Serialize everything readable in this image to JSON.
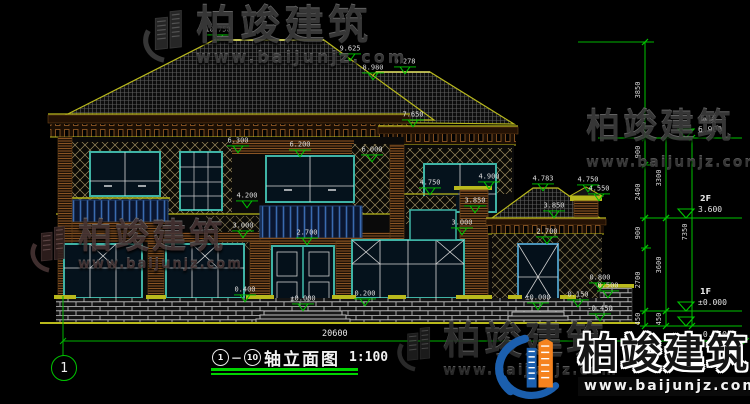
{
  "colors": {
    "annotation_green": "#00c400",
    "line_yellow": "#b9b91c",
    "window_teal": "#3fb3a5",
    "brand_blue": "#1b5fae",
    "brand_orange": "#f5831f"
  },
  "watermarks": {
    "brand": "柏竣建筑",
    "url": "www.baijunjz.com"
  },
  "logo": {
    "brand": "柏竣建筑",
    "url": "www.baijunjz.com"
  },
  "title_block": {
    "axis_start": "1",
    "axis_end": "10",
    "name": "轴立面图",
    "scale": "1:100"
  },
  "axis_bubble": {
    "label": "1"
  },
  "bottom_dim": {
    "value": "20600"
  },
  "elevation_markers": [
    {
      "label": "10.750",
      "x": 218,
      "y": 41
    },
    {
      "label": "9.625",
      "x": 350,
      "y": 60
    },
    {
      "label": "8.980",
      "x": 373,
      "y": 79
    },
    {
      "label": "9.278",
      "x": 405,
      "y": 73
    },
    {
      "label": "7.650",
      "x": 413,
      "y": 126
    },
    {
      "label": "6.300",
      "x": 238,
      "y": 152
    },
    {
      "label": "6.200",
      "x": 300,
      "y": 156
    },
    {
      "label": "6.000",
      "x": 372,
      "y": 161
    },
    {
      "label": "4.900",
      "x": 489,
      "y": 188
    },
    {
      "label": "4.750",
      "x": 430,
      "y": 194
    },
    {
      "label": "4.783",
      "x": 543,
      "y": 190
    },
    {
      "label": "4.750",
      "x": 588,
      "y": 191
    },
    {
      "label": "4.550",
      "x": 599,
      "y": 200
    },
    {
      "label": "4.200",
      "x": 247,
      "y": 207
    },
    {
      "label": "3.850",
      "x": 475,
      "y": 212
    },
    {
      "label": "3.850",
      "x": 554,
      "y": 217
    },
    {
      "label": "3.000",
      "x": 243,
      "y": 237
    },
    {
      "label": "3.000",
      "x": 462,
      "y": 234
    },
    {
      "label": "2.700",
      "x": 307,
      "y": 244
    },
    {
      "label": "2.700",
      "x": 547,
      "y": 243
    },
    {
      "label": "0.400",
      "x": 245,
      "y": 301
    },
    {
      "label": "0.200",
      "x": 365,
      "y": 305
    },
    {
      "label": "±0.000",
      "x": 303,
      "y": 310
    },
    {
      "label": "±0.000",
      "x": 538,
      "y": 309
    },
    {
      "label": "0.800",
      "x": 600,
      "y": 289
    },
    {
      "label": "0.500",
      "x": 608,
      "y": 297
    },
    {
      "label": "0.150",
      "x": 578,
      "y": 306
    },
    {
      "label": "-0.450",
      "x": 600,
      "y": 320
    }
  ],
  "level_labels": [
    {
      "name": "屋顶",
      "value": "6.900",
      "y": 138,
      "text_below": false
    },
    {
      "name": "2F",
      "value": "3.600",
      "y": 218,
      "text_below": false
    },
    {
      "name": "1F",
      "value": "±0.000",
      "y": 311,
      "text_below": false
    },
    {
      "name": "",
      "value": "-0.450",
      "y": 326,
      "text_below": true
    }
  ],
  "dim_segments": [
    {
      "value": "3850",
      "x": 645,
      "y1": 42,
      "y2": 138
    },
    {
      "value": "900",
      "x": 645,
      "y1": 138,
      "y2": 165
    },
    {
      "value": "2400",
      "x": 645,
      "y1": 165,
      "y2": 218
    },
    {
      "value": "900",
      "x": 645,
      "y1": 218,
      "y2": 248
    },
    {
      "value": "2700",
      "x": 645,
      "y1": 248,
      "y2": 311
    },
    {
      "value": "450",
      "x": 645,
      "y1": 311,
      "y2": 326
    },
    {
      "value": "3300",
      "x": 666,
      "y1": 138,
      "y2": 218
    },
    {
      "value": "3600",
      "x": 666,
      "y1": 218,
      "y2": 311
    },
    {
      "value": "450",
      "x": 666,
      "y1": 311,
      "y2": 326
    },
    {
      "value": "7350",
      "x": 692,
      "y1": 138,
      "y2": 326
    }
  ]
}
